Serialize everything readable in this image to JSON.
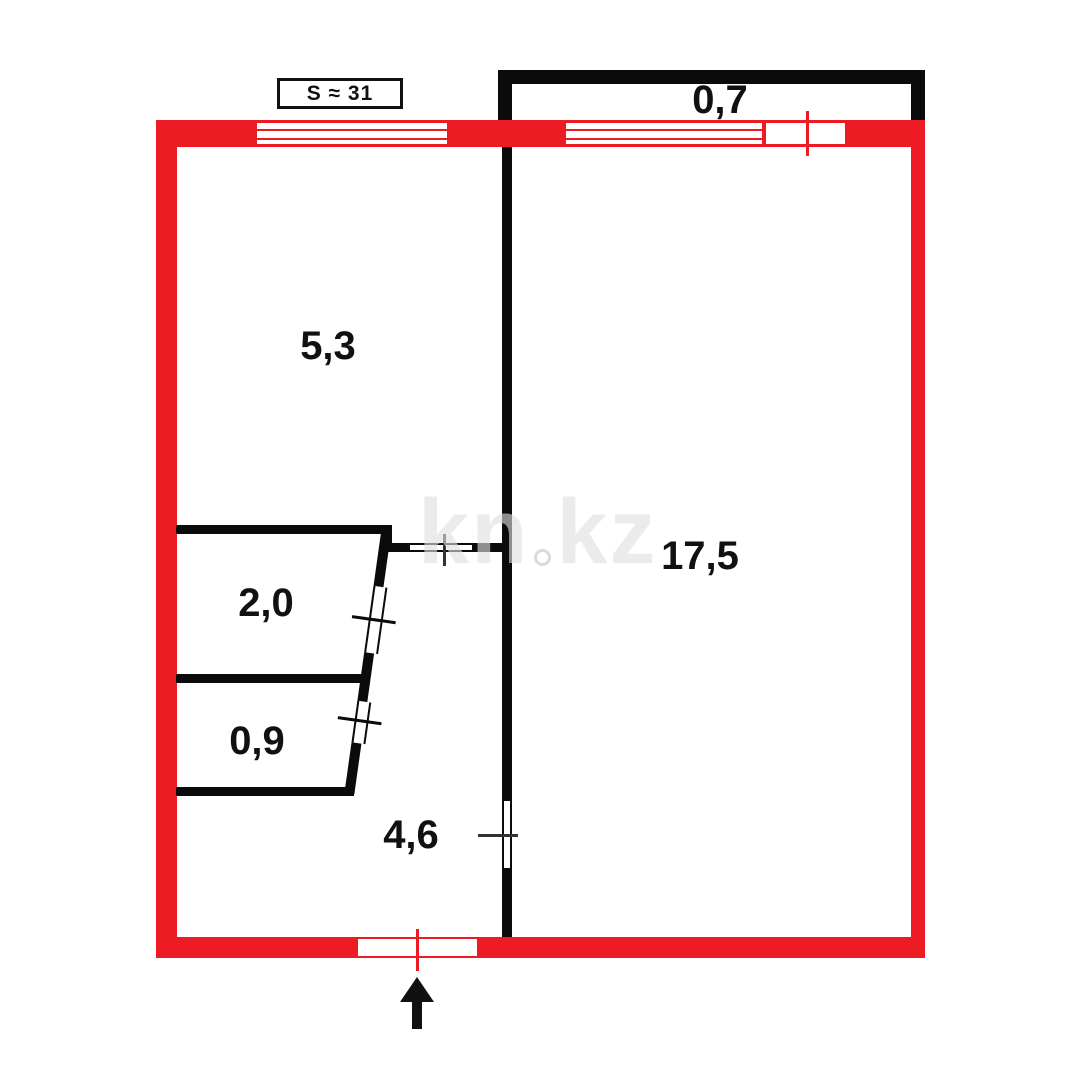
{
  "plan": {
    "total_area_label": "S ≈ 31",
    "rooms": [
      {
        "id": "balcony",
        "area": "0,7"
      },
      {
        "id": "room-a",
        "area": "5,3"
      },
      {
        "id": "room-b",
        "area": "17,5"
      },
      {
        "id": "storage-a",
        "area": "2,0"
      },
      {
        "id": "storage-b",
        "area": "0,9"
      },
      {
        "id": "hallway",
        "area": "4,6"
      }
    ],
    "watermark": {
      "text": "kn.kz",
      "left": "kn",
      "right": "kz"
    },
    "colors": {
      "wall_outer": "#ED1C24",
      "wall_inner": "#0B0B0B",
      "door_tick": "#333333",
      "label_text": "#111111",
      "background": "#FFFFFF"
    }
  }
}
